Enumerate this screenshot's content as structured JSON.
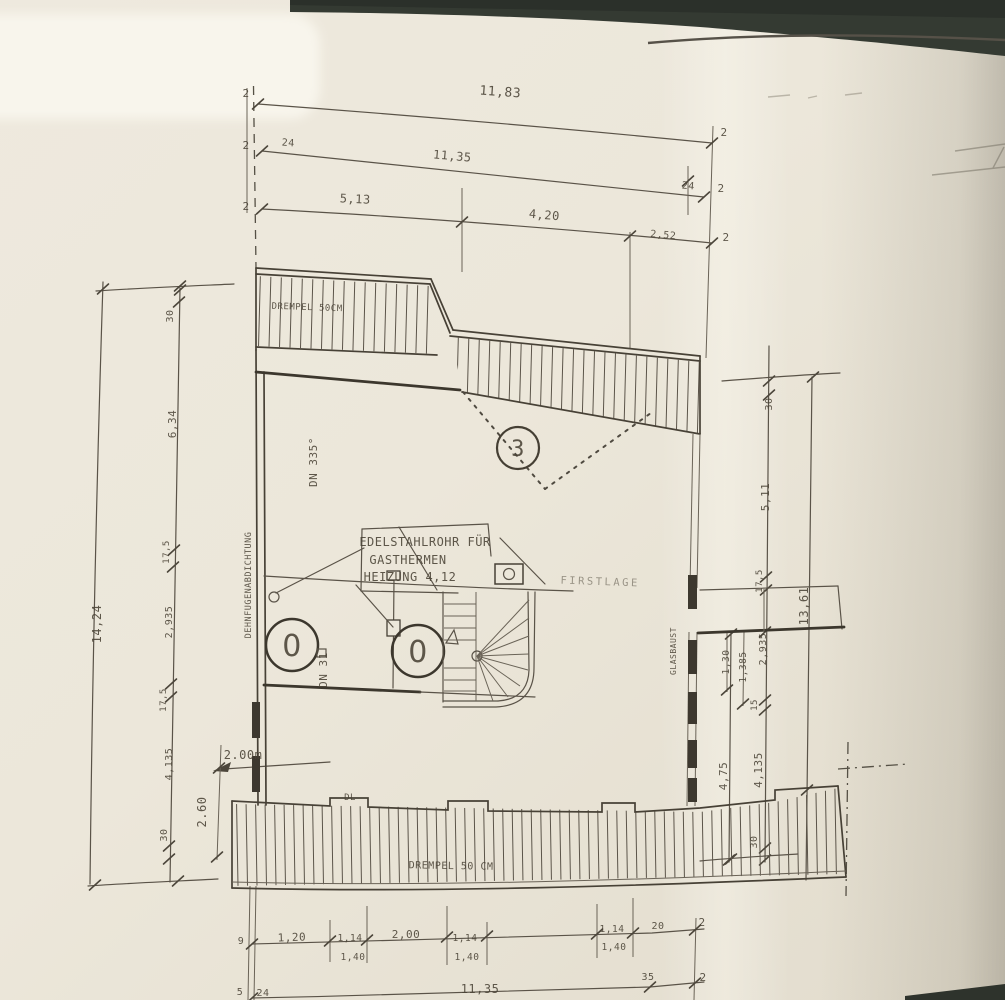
{
  "drawing": {
    "top": {
      "row1": {
        "left_tick": "2",
        "total": "11,83",
        "right_tick": "2"
      },
      "row2": {
        "left_tick": "2",
        "left_seg": "24",
        "total": "11,35",
        "right_seg": "24",
        "right_tick": "2"
      },
      "row3": {
        "left_tick": "2",
        "seg1": "5,13",
        "seg2": "4,20",
        "seg3": "2,52",
        "right_tick": "2"
      }
    },
    "left": {
      "total": "14,24",
      "segments": [
        "30",
        "6,34",
        "17,5",
        "2,935",
        "17,5",
        "4,135",
        "30"
      ],
      "joint_note": "DEHNFUGENABDICHTUNG",
      "pipe_note": "DN 335°",
      "width_note": "2.00m",
      "height_note": "2.60"
    },
    "right": {
      "total": "13,61",
      "segments": [
        "30",
        "5,11",
        "17,5"
      ],
      "lower_segments": [
        "1,30",
        "1,385",
        "2,935",
        "15",
        "4,75",
        "4,135",
        "30"
      ],
      "wall_note": "GLASBAUST"
    },
    "bottom": {
      "row1": [
        "9",
        "1,20",
        "1,14",
        "2,00",
        "1,14",
        "1,14",
        "20",
        "2"
      ],
      "row1_sub": [
        "1,40",
        "1,40",
        "1,40"
      ],
      "row2": [
        "5",
        "24",
        "11,35",
        "35",
        "2"
      ]
    },
    "plan": {
      "drempel_top": "DREMPEL 50CM",
      "drempel_bottom": "DREMPEL 50 CM",
      "duct_label_line1": "EDELSTAHLROHR FÜR",
      "duct_label_line2": "GASTHERMEN",
      "duct_label_line3": "HEIZUNG 4,12",
      "ridge_label": "FIRSTLAGE",
      "pipe_label": "DN 31",
      "door_label": "DL",
      "position_marker": "3",
      "opening_marker_left": "0",
      "opening_marker_right": "0"
    }
  }
}
